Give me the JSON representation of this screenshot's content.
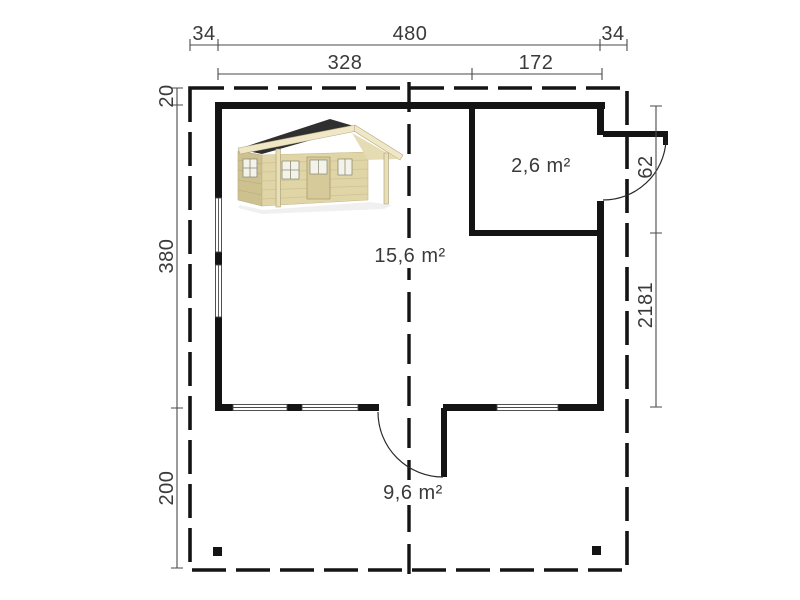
{
  "page": {
    "background": "#ffffff",
    "description_label": "floor-plan"
  },
  "dimensions": {
    "top_row": {
      "left_margin": "34",
      "overall_width": "480",
      "right_margin": "34"
    },
    "split_row": {
      "main_width": "328",
      "annex_width": "172"
    },
    "left_col": {
      "top_offset": "20",
      "building_depth": "380",
      "terrace_depth": "200"
    },
    "right_col": {
      "door_opening": "62",
      "wall_segment": "2181"
    }
  },
  "rooms": {
    "annex_area": "2,6 m²",
    "main_area": "15,6 m²",
    "terrace_area": "9,6 m²"
  },
  "colors": {
    "wall": "#141414",
    "dimension_line": "#4a4a4a",
    "label_text": "#3a3a3a",
    "cabin_wall_front": "#e0d5a6",
    "cabin_wall_side": "#cdc190",
    "cabin_roof": "#2f2f2f",
    "cabin_trim": "#efe7c6"
  }
}
